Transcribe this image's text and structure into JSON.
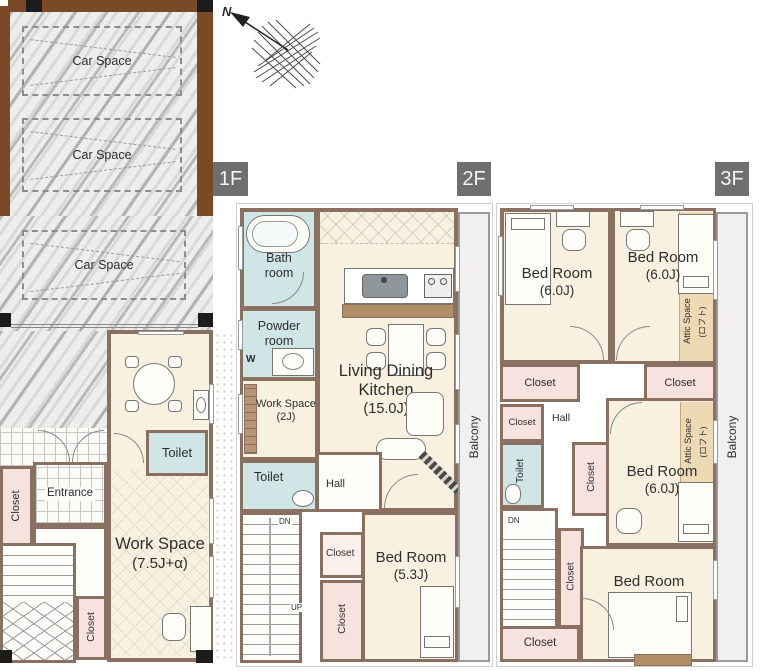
{
  "badges": {
    "f1": "1F",
    "f2": "2F",
    "f3": "3F"
  },
  "compass": {
    "north": "N"
  },
  "car_spaces": [
    "Car Space",
    "Car Space",
    "Car Space"
  ],
  "f1": {
    "toilet": "Toilet",
    "closet_entry": "Closet",
    "entrance": "Entrance",
    "hall": "Hall",
    "up": "UP",
    "closet_stairs": "Closet",
    "work_space": "Work Space",
    "work_space_size": "(7.5J+α)"
  },
  "f2": {
    "bath_1": "Bath",
    "bath_2": "room",
    "powder_1": "Powder",
    "powder_2": "room",
    "washer": "W",
    "work_space": "Work Space",
    "work_space_size": "(2J)",
    "toilet": "Toilet",
    "hall": "Hall",
    "ldk_1": "Living Dining",
    "ldk_2": "Kitchen",
    "ldk_3": "(15.0J)",
    "dn": "DN",
    "up": "UP",
    "closet_hall": "Closet",
    "closet_bed": "Closet",
    "bed_room": "Bed Room",
    "bed_room_size": "(5.3J)",
    "balcony": "Balcony"
  },
  "f3": {
    "bed1": "Bed Room",
    "bed1_size": "(6.0J)",
    "bed2": "Bed Room",
    "bed2_size": "(6.0J)",
    "attic1": "Attic Space",
    "attic1_sub": "(ロフト)",
    "closet_tl": "Closet",
    "closet_tr": "Closet",
    "closet_small": "Closet",
    "hall": "Hall",
    "toilet": "Toilet",
    "closet_mid": "Closet",
    "bed3": "Bed Room",
    "bed3_size": "(6.0J)",
    "attic2": "Attic Space",
    "attic2_sub": "(ロフト)",
    "dn": "DN",
    "closet_stairs": "Closet",
    "closet_bottom": "Closet",
    "bed4": "Bed Room",
    "bed4_size": "(6.0J)",
    "balcony": "Balcony"
  },
  "colors": {
    "wall": "#8a7060",
    "room_cream": "#f8f1df",
    "wet_blue": "#cfe5e6",
    "closet_pink": "#f7e3dd",
    "attic_tan": "#eed9b5",
    "balcony_gray": "#f1f0ee",
    "badge_gray": "#6f6f6f",
    "garage_brown": "#7a4a28",
    "post_black": "#1c1c1c"
  }
}
